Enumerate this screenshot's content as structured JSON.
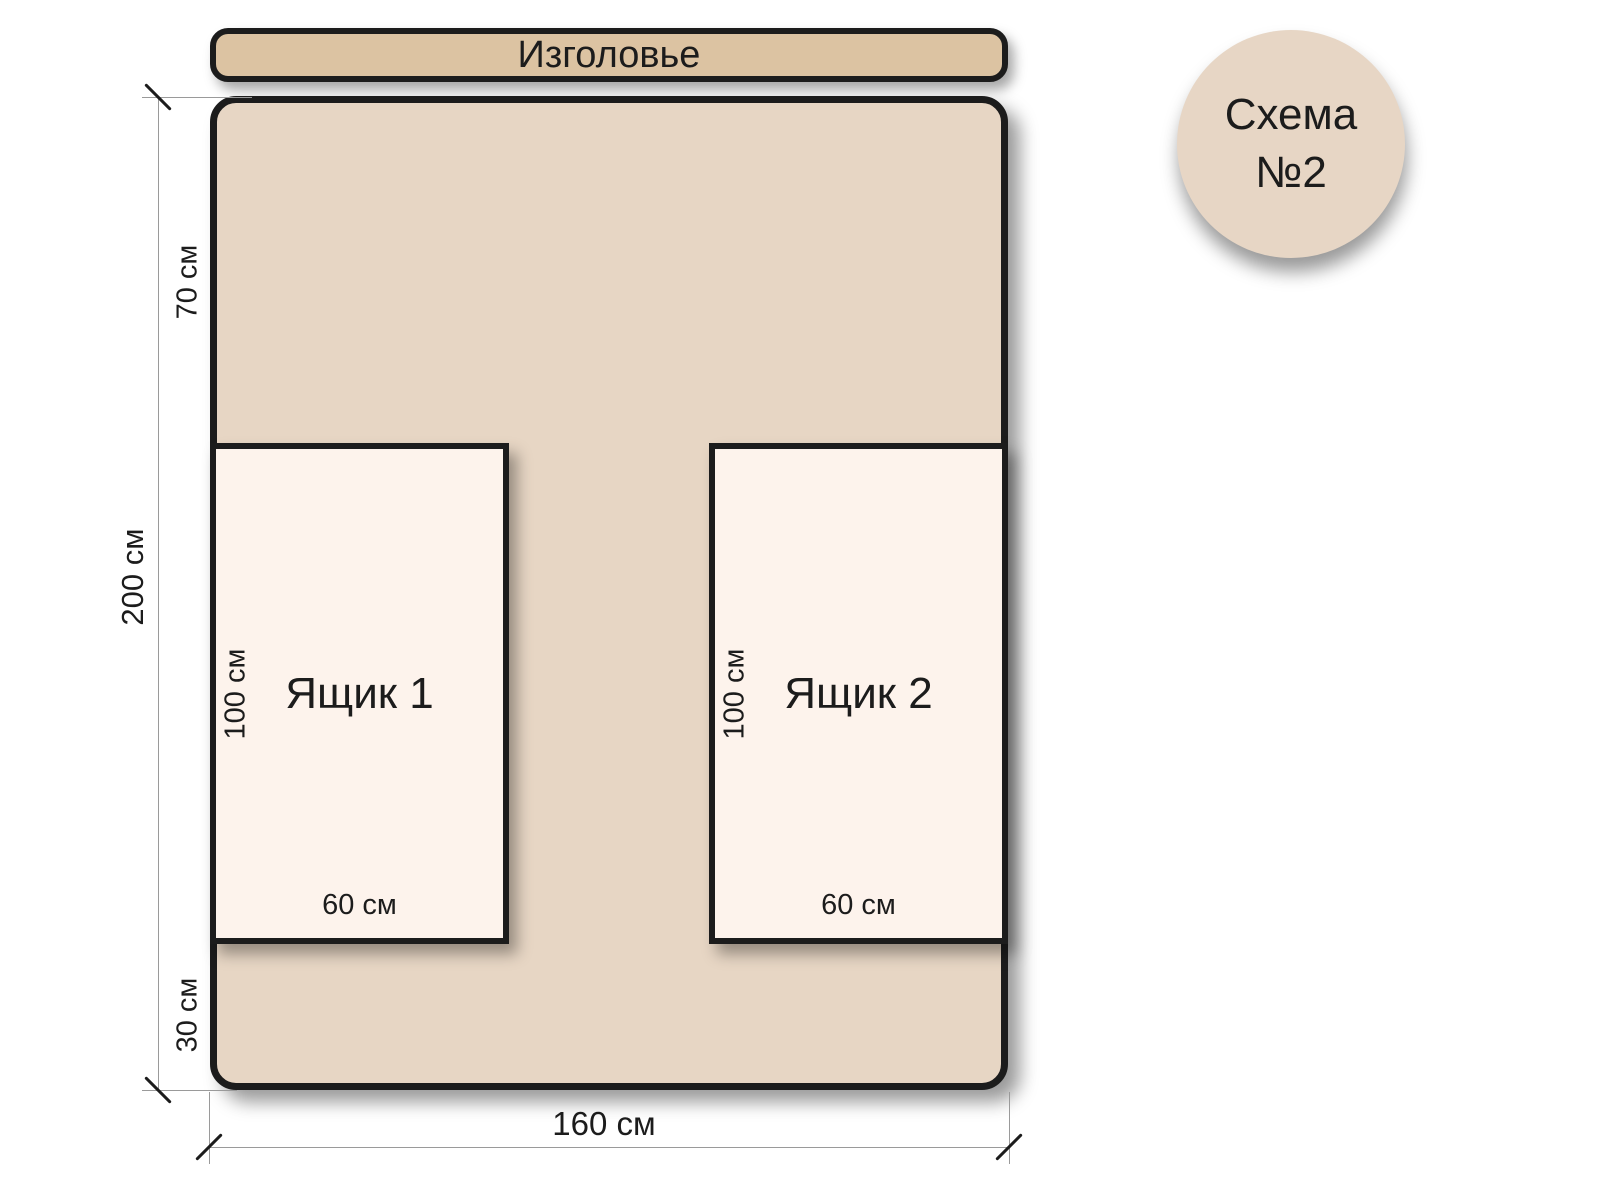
{
  "badge": {
    "line1": "Схема",
    "line2": "№2"
  },
  "headboard": {
    "label": "Изголовье"
  },
  "drawers": [
    {
      "name": "Ящик 1",
      "height": "100 см",
      "width": "60 см"
    },
    {
      "name": "Ящик 2",
      "height": "100 см",
      "width": "60 см"
    }
  ],
  "dimensions": {
    "total_height": "200 см",
    "top_gap": "70 см",
    "bottom_gap": "30 см",
    "total_width": "160 см"
  },
  "colors": {
    "headboard": "#dcc3a2",
    "bed": "#e7d6c4",
    "drawer": "#fdf3ec",
    "badge": "#e7d6c5",
    "outline": "#1c1c1c",
    "dim_line": "#9a9a9a"
  }
}
